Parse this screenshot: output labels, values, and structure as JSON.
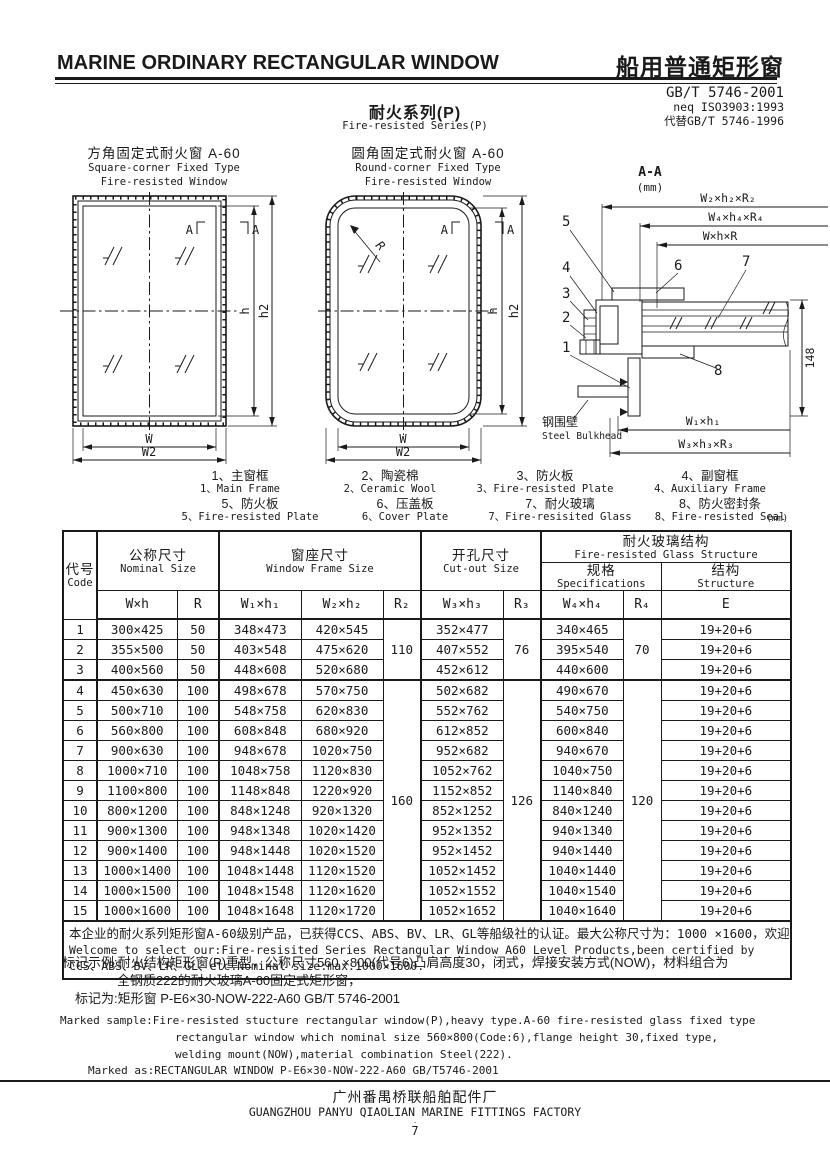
{
  "colors": {
    "ink": "#1a1a1a",
    "paper": "#ffffff"
  },
  "header": {
    "title_en": "MARINE ORDINARY RECTANGULAR WINDOW",
    "title_zh": "船用普通矩形窗",
    "standard": "GB/T 5746-2001",
    "standard_neq": "neq ISO3903:1993",
    "standard_replaces": "代替GB/T 5746-1996",
    "series_zh": "耐火系列(P)",
    "series_en": "Fire-resisted Series(P)"
  },
  "diagrams": {
    "square": {
      "title_zh": "方角固定式耐火窗  A-60",
      "title_en_1": "Square-corner Fixed Type",
      "title_en_2": "Fire-resisted Window",
      "label_a_left": "A",
      "label_a_right": "A",
      "dim_h": "h",
      "dim_h2": "h2",
      "dim_w": "W",
      "dim_w2": "W2"
    },
    "round": {
      "title_zh": "圆角固定式耐火窗  A-60",
      "title_en_1": "Round-corner Fixed Type",
      "title_en_2": "Fire-resisted Window",
      "label_a_left": "A",
      "label_a_right": "A",
      "dim_r": "R",
      "dim_h": "h",
      "dim_h2": "h2",
      "dim_w": "W",
      "dim_w2": "W2"
    },
    "section": {
      "title": "A-A",
      "unit": "(mm)",
      "dims_top": [
        "W₂×h₂×R₂",
        "W₄×h₄×R₄",
        "W×h×R"
      ],
      "dims_bottom": [
        "W₁×h₁",
        "W₃×h₃×R₃"
      ],
      "dim_height": "148",
      "bulkhead_zh": "钢围壁",
      "bulkhead_en": "Steel Bulkhead",
      "callouts": {
        "c1": "1",
        "c2": "2",
        "c3": "3",
        "c4": "4",
        "c5": "5",
        "c6": "6",
        "c7": "7",
        "c8": "8"
      }
    }
  },
  "legend": {
    "unit": "(mm)",
    "items": [
      {
        "zh": "1、主窗框",
        "en": "1、Main Frame"
      },
      {
        "zh": "2、陶瓷棉",
        "en": "2、Ceramic Wool"
      },
      {
        "zh": "3、防火板",
        "en": "3、Fire-resisted Plate"
      },
      {
        "zh": "4、副窗框",
        "en": "4、Auxiliary Frame"
      },
      {
        "zh": "5、防火板",
        "en": "5、Fire-resisted Plate"
      },
      {
        "zh": "6、压盖板",
        "en": "6、Cover Plate"
      },
      {
        "zh": "7、耐火玻璃",
        "en": "7、Fire-resisited Glass"
      },
      {
        "zh": "8、防火密封条",
        "en": "8、Fire-resisted Seal"
      }
    ]
  },
  "table": {
    "header": {
      "code_zh": "代号",
      "code_en": "Code",
      "nominal_zh": "公称尺寸",
      "nominal_en": "Nominal Size",
      "frame_zh": "窗座尺寸",
      "frame_en": "Window Frame Size",
      "cutout_zh": "开孔尺寸",
      "cutout_en": "Cut-out Size",
      "glass_zh": "耐火玻璃结构",
      "glass_en": "Fire-resisted Glass Structure",
      "spec_zh": "规格",
      "spec_en": "Specifications",
      "struct_zh": "结构",
      "struct_en": "Structure",
      "sym": {
        "wh": "W×h",
        "r": "R",
        "w1h1": "W₁×h₁",
        "w2h2": "W₂×h₂",
        "r2": "R₂",
        "w3h3": "W₃×h₃",
        "r3": "R₃",
        "w4h4": "W₄×h₄",
        "r4": "R₄",
        "e": "E"
      }
    },
    "merged": {
      "r2_a": "110",
      "r2_b": "160",
      "r3_a": "76",
      "r3_b": "126",
      "r4_a": "70",
      "r4_b": "120"
    },
    "rows": [
      [
        "1",
        "300×425",
        "50",
        "348×473",
        "420×545",
        "352×477",
        "340×465",
        "19+20+6"
      ],
      [
        "2",
        "355×500",
        "50",
        "403×548",
        "475×620",
        "407×552",
        "395×540",
        "19+20+6"
      ],
      [
        "3",
        "400×560",
        "50",
        "448×608",
        "520×680",
        "452×612",
        "440×600",
        "19+20+6"
      ],
      [
        "4",
        "450×630",
        "100",
        "498×678",
        "570×750",
        "502×682",
        "490×670",
        "19+20+6"
      ],
      [
        "5",
        "500×710",
        "100",
        "548×758",
        "620×830",
        "552×762",
        "540×750",
        "19+20+6"
      ],
      [
        "6",
        "560×800",
        "100",
        "608×848",
        "680×920",
        "612×852",
        "600×840",
        "19+20+6"
      ],
      [
        "7",
        "900×630",
        "100",
        "948×678",
        "1020×750",
        "952×682",
        "940×670",
        "19+20+6"
      ],
      [
        "8",
        "1000×710",
        "100",
        "1048×758",
        "1120×830",
        "1052×762",
        "1040×750",
        "19+20+6"
      ],
      [
        "9",
        "1100×800",
        "100",
        "1148×848",
        "1220×920",
        "1152×852",
        "1140×840",
        "19+20+6"
      ],
      [
        "10",
        "800×1200",
        "100",
        "848×1248",
        "920×1320",
        "852×1252",
        "840×1240",
        "19+20+6"
      ],
      [
        "11",
        "900×1300",
        "100",
        "948×1348",
        "1020×1420",
        "952×1352",
        "940×1340",
        "19+20+6"
      ],
      [
        "12",
        "900×1400",
        "100",
        "948×1448",
        "1020×1520",
        "952×1452",
        "940×1440",
        "19+20+6"
      ],
      [
        "13",
        "1000×1400",
        "100",
        "1048×1448",
        "1120×1520",
        "1052×1452",
        "1040×1440",
        "19+20+6"
      ],
      [
        "14",
        "1000×1500",
        "100",
        "1048×1548",
        "1120×1620",
        "1052×1552",
        "1040×1540",
        "19+20+6"
      ],
      [
        "15",
        "1000×1600",
        "100",
        "1048×1648",
        "1120×1720",
        "1052×1652",
        "1040×1640",
        "19+20+6"
      ]
    ],
    "note_zh": "本企业的耐火系列矩形窗A-60级别产品，已获得CCS、ABS、BV、LR、GL等船级社的认证。最大公称尺寸为：1000 ×1600，欢迎选用。",
    "note_en_1": "Welcome to select our:Fire-resisited Series Rectangular Window A60 Level Products,been certified by",
    "note_en_2": "CCS、ABS、BV、LR、GL、etc.Nominal size:max.1000×1600."
  },
  "marking": {
    "zh_1": "标记示例:耐火结构矩形窗(P)重型，公称尺寸560 ×800(代号6)凸肩高度30，闭式，焊接安装方式(NOW)，材料组合为",
    "zh_2": "全钢质222的耐火玻璃A-60固定式矩形窗，",
    "zh_3": "标记为:矩形窗  P-E6×30-NOW-222-A60  GB/T 5746-2001",
    "en_1": "Marked sample:Fire-resisted stucture rectangular window(P),heavy type.A-60 fire-resisted glass fixed type",
    "en_2": "rectangular window which nominal size 560×800(Code:6),flange height 30,fixed type,",
    "en_3": "welding mount(NOW),material combination Steel(222).",
    "en_4": "Marked as:RECTANGULAR WINDOW  P-E6×30-NOW-222-A60  GB/T5746-2001"
  },
  "footer": {
    "factory_zh": "广州番禺桥联船舶配件厂",
    "factory_en": "GUANGZHOU PANYU QIAOLIAN MARINE FITTINGS FACTORY",
    "page_dot": "·",
    "page_number": "7"
  }
}
